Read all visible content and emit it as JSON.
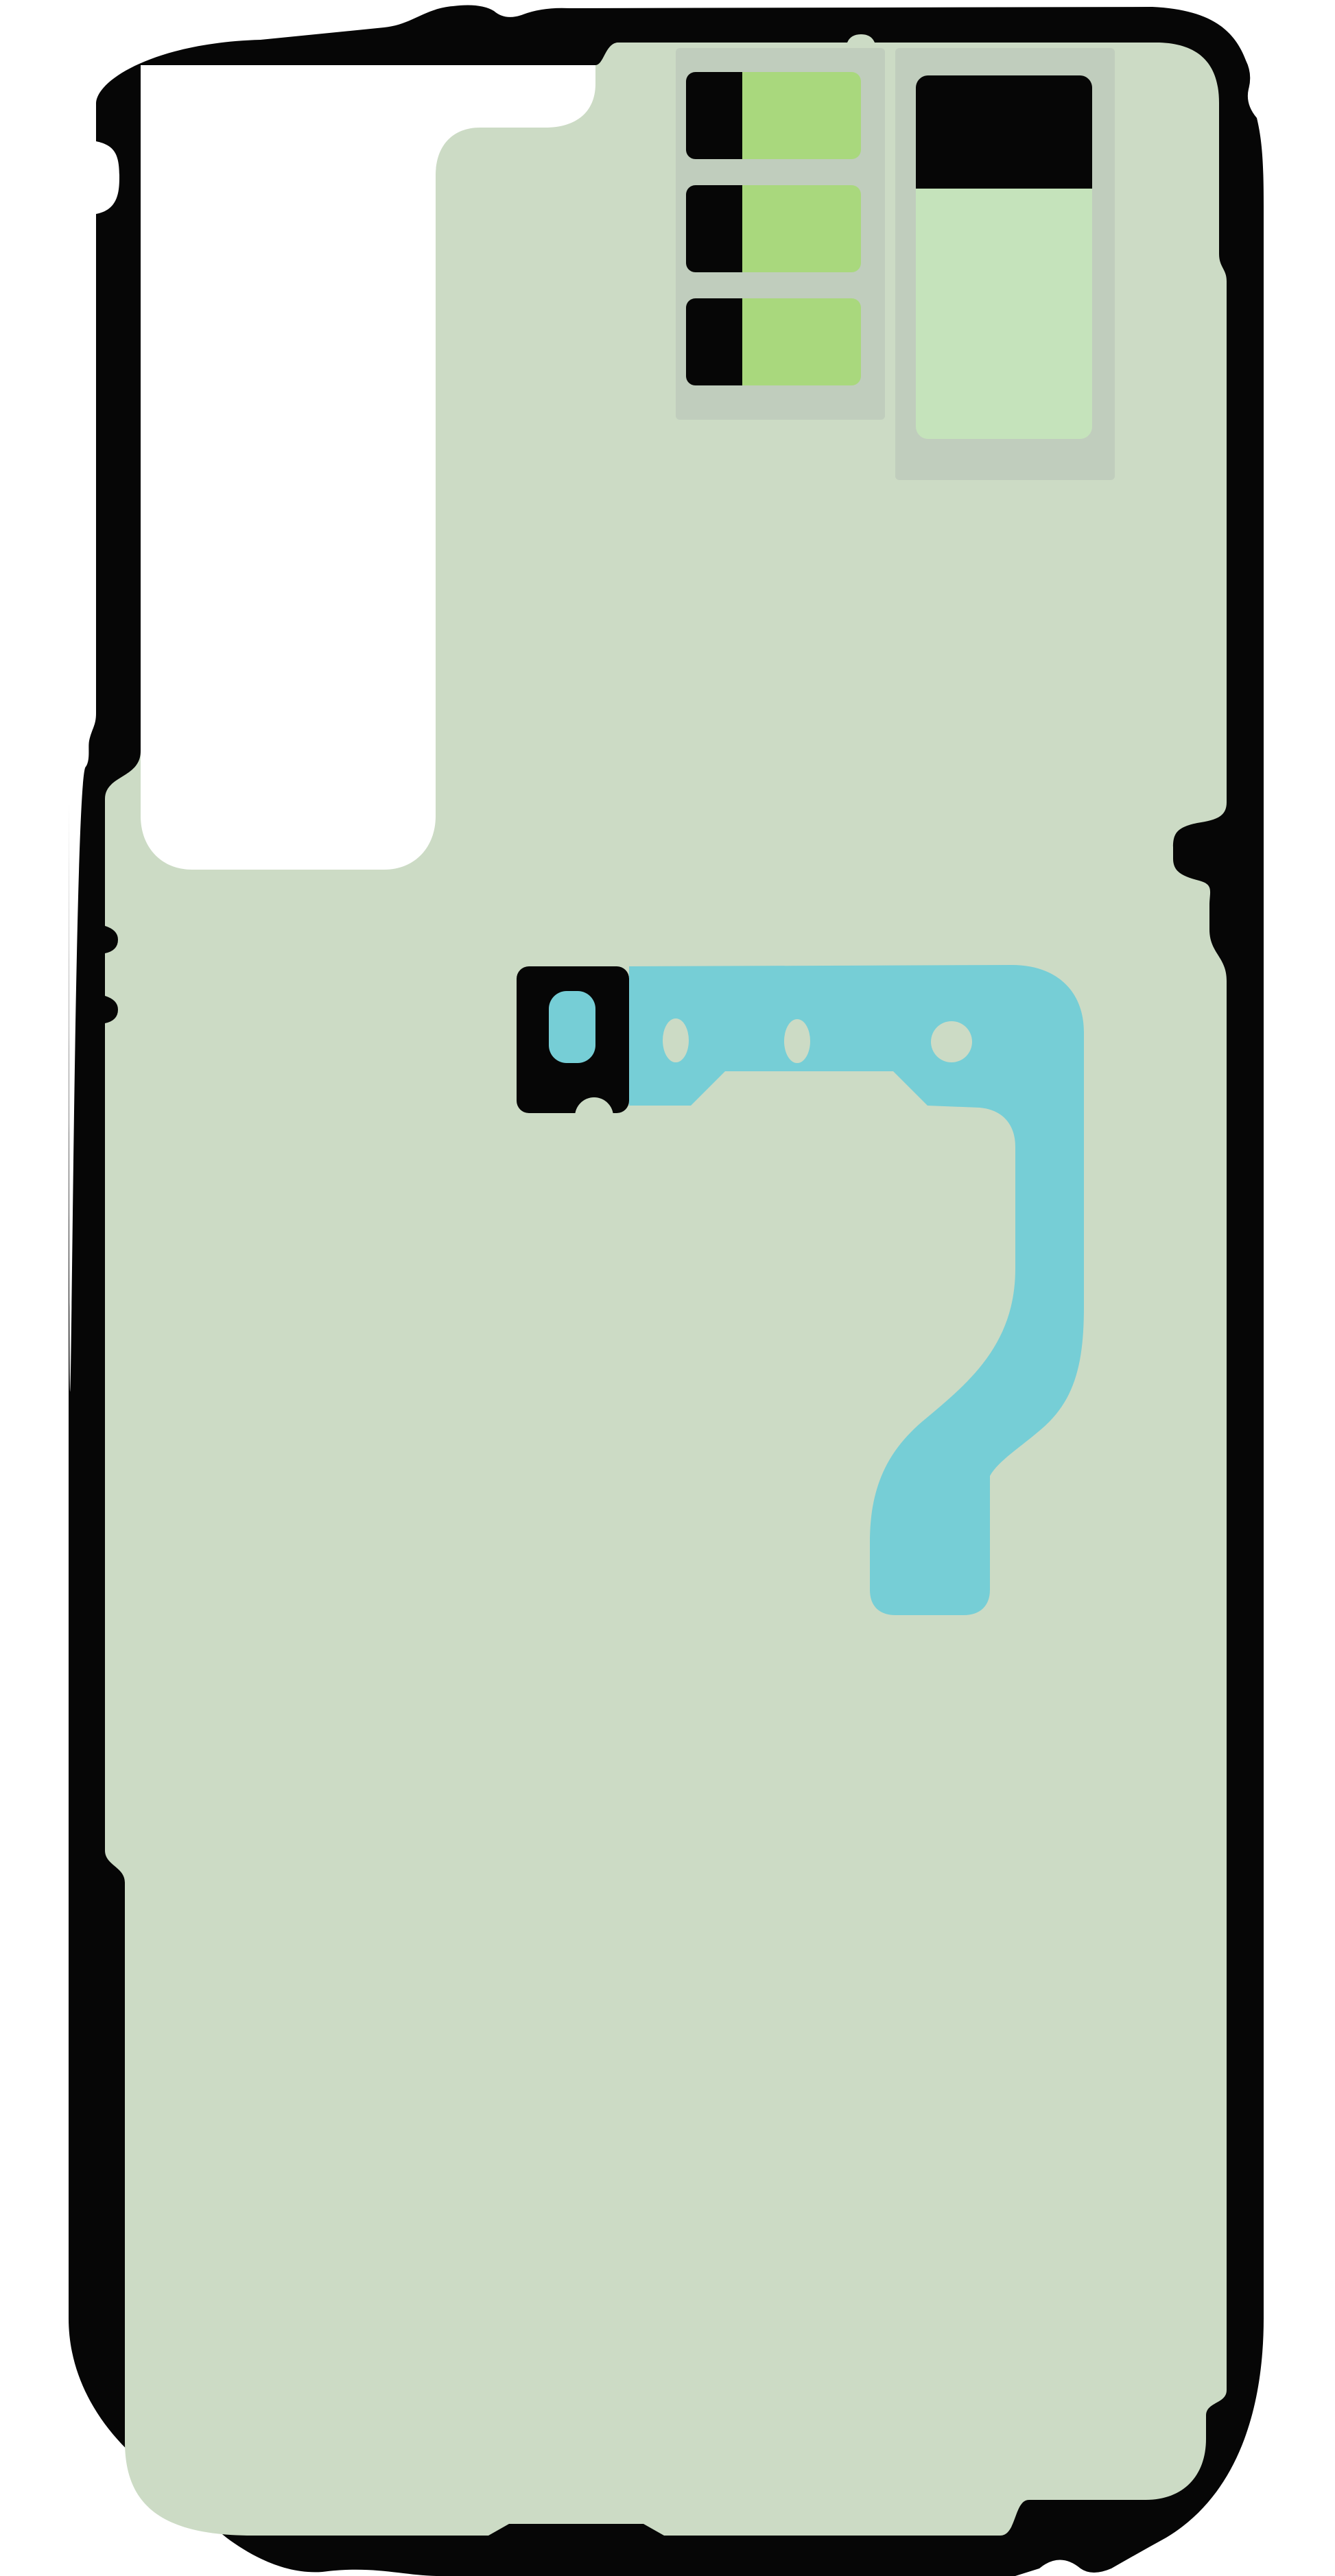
{
  "image": {
    "alt": "Rear cover adhesive sticker sheet kit for a smartphone, shown flat on a white background",
    "kind": "product-illustration"
  },
  "colors": {
    "page_background": "#ffffff",
    "frame_black": "#060606",
    "sheet_green": "#ccdbc5",
    "panel_gray_green": "#c0cdbd",
    "bright_green": "#a9d87d",
    "mint_green": "#c5e3bb",
    "teal": "#76ced6",
    "white_piece": "#ffffff"
  },
  "parts": {
    "frame": "back-cover-outline-adhesive",
    "white_piece": "camera-area-protective-film",
    "small_strips": "button-adhesive-strips",
    "battery_card": "battery-adhesive-card",
    "camera_bracket": "camera-bracket-adhesive",
    "flex_shape": "flex-cable-shaped-adhesive"
  }
}
